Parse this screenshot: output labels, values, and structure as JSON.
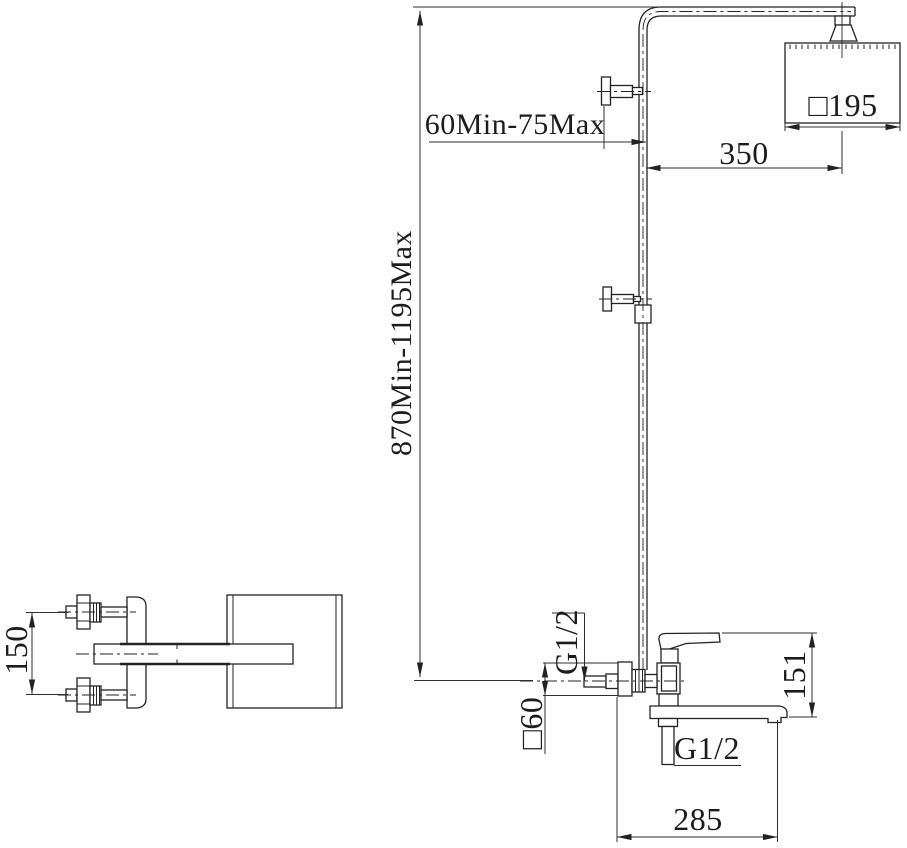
{
  "labels": {
    "height_range": "870Min-1195Max",
    "bracket_height_range": "60Min-75Max",
    "arm_projection": "350",
    "head_size": "□195",
    "inlet_thread": "G1/2",
    "escutcheon_size": "□60",
    "body_height": "151",
    "outlet_thread": "G1/2",
    "spout_reach": "285",
    "inlet_spacing": "150"
  }
}
